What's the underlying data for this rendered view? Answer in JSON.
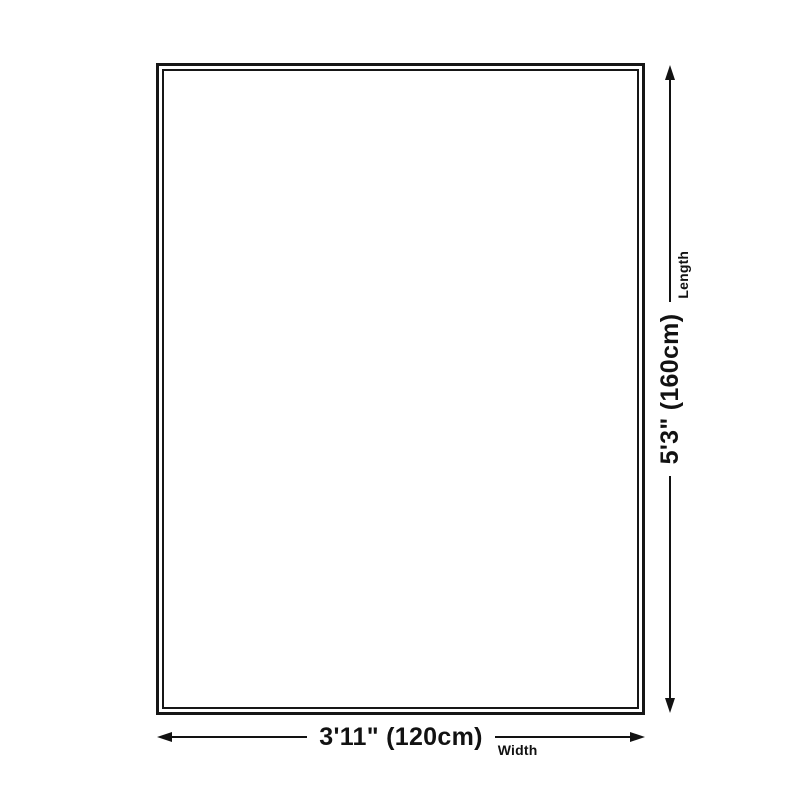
{
  "colors": {
    "background": "#ffffff",
    "ink": "#121212"
  },
  "rug_outline": {
    "description": "empty rectangle with double border"
  },
  "dimensions": {
    "length": {
      "label": "Length",
      "value": "5'3\" (160cm)"
    },
    "width": {
      "label": "Width",
      "value": "3'11\" (120cm)"
    }
  }
}
